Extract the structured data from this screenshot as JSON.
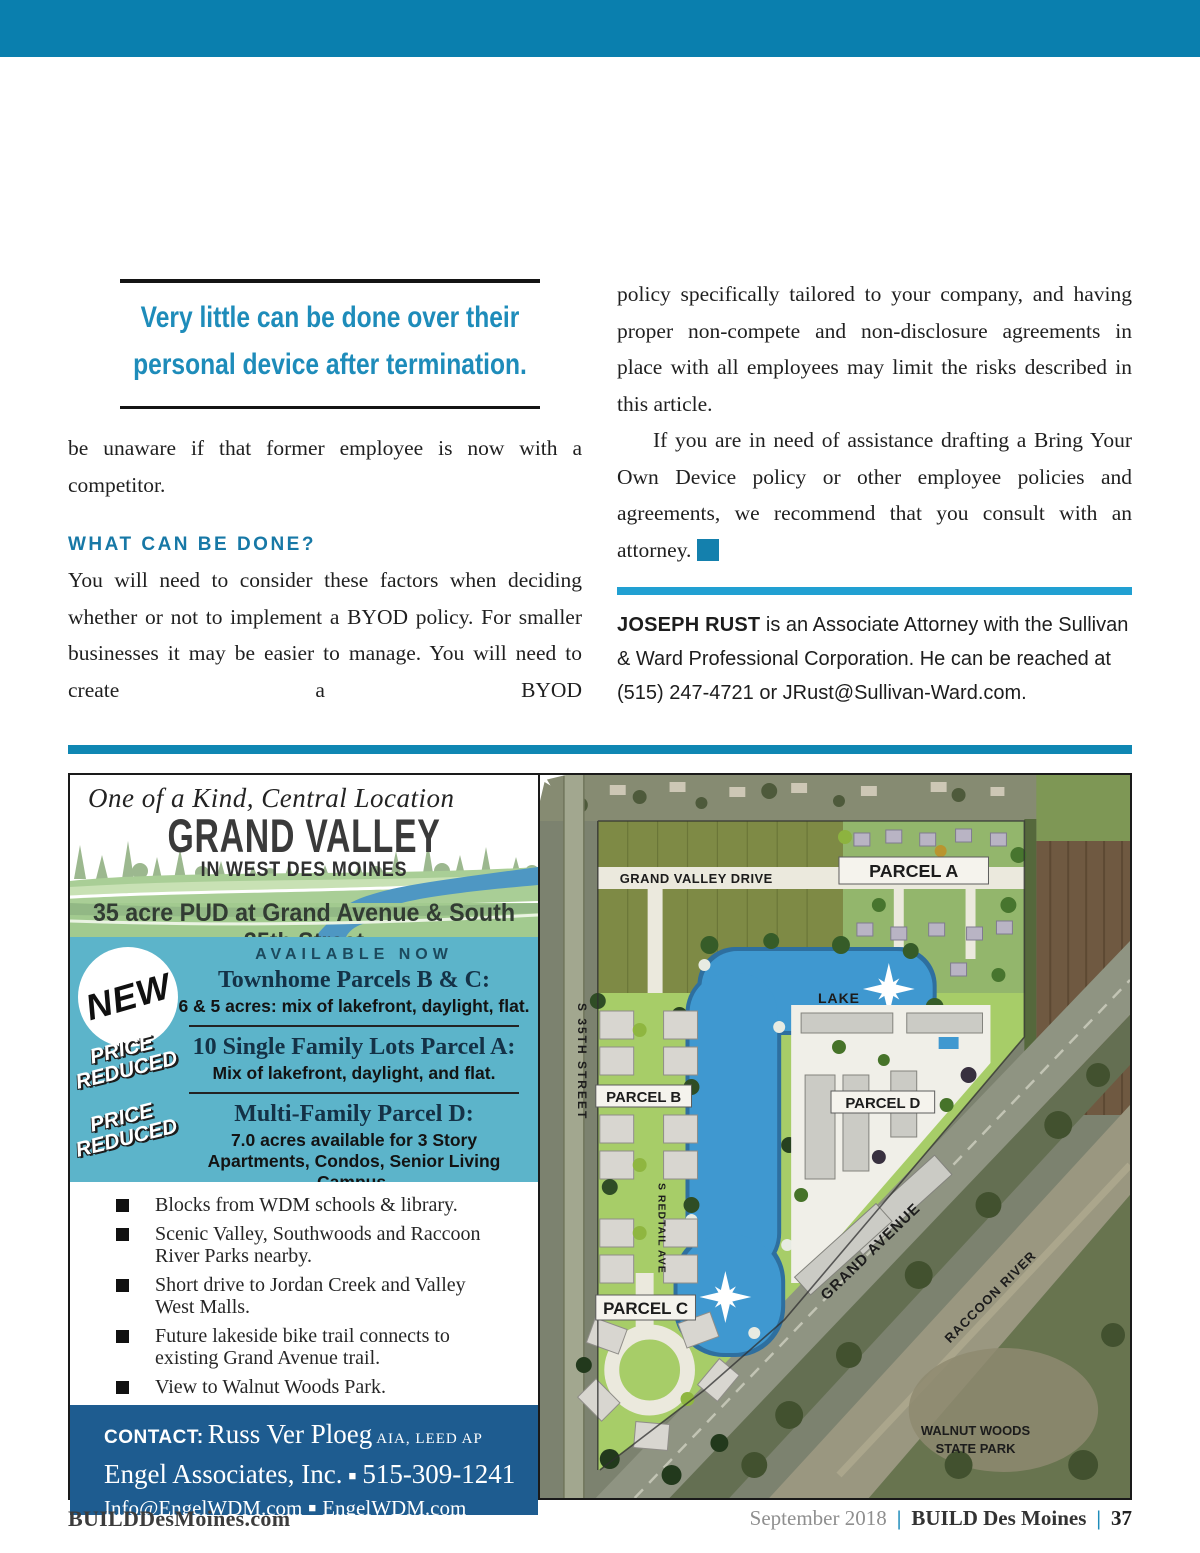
{
  "colors": {
    "top_bar": "#0a7fae",
    "quote_blue": "#1e8cba",
    "heading_blue": "#1778a6",
    "bio_rule_blue": "#21a0d2",
    "ad_divider_blue": "#0f87b3",
    "teal_panel": "#5cb4ca",
    "contact_blue": "#1e5c90"
  },
  "article": {
    "pull_quote": {
      "line1": "Very little can be done over their",
      "line2": "personal device after termination."
    },
    "left_column": {
      "para1": "be unaware if that former employee is now with a competitor.",
      "heading": "WHAT CAN BE DONE?",
      "para2": "You will need to consider these factors when deciding whether or not to implement a BYOD policy. For smaller businesses it may be easier to manage. You will need to create a BYOD"
    },
    "right_column": {
      "para1": "policy specifically tailored to your company, and having proper non-compete and non-disclosure agreements in place with all employees may limit the risks described in this article.",
      "para2": "If you are in need of assistance drafting a Bring Your Own Device policy or other employee policies and agreements, we recommend that you consult with an attorney.",
      "end_mark": "B",
      "bio_name": "JOSEPH RUST",
      "bio_rest": " is an Associate Attorney with the Sullivan & Ward Professional Corporation. He can be reached at (515) 247-4721 or JRust@Sullivan-Ward.com."
    }
  },
  "ad": {
    "tagline": "One of a Kind, Central Location",
    "title": "GRAND VALLEY",
    "subtitle": "IN WEST DES MOINES",
    "band": "35 acre PUD at Grand Avenue & South 35th Street",
    "available_now": "AVAILABLE NOW",
    "badges": {
      "new": "NEW",
      "price_reduced": "PRICE REDUCED"
    },
    "offers": [
      {
        "title": "Townhome Parcels B & C:",
        "desc": "6 & 5 acres: mix of lakefront, daylight, flat."
      },
      {
        "title": "10 Single Family Lots Parcel A:",
        "desc": "Mix of lakefront, daylight, and flat."
      },
      {
        "title": "Multi-Family Parcel D:",
        "desc": "7.0 acres available for 3 Story Apartments, Condos,  Senior Living Campus."
      }
    ],
    "bullets": [
      "Blocks from WDM schools & library.",
      "Scenic Valley, Southwoods and Raccoon River Parks nearby.",
      "Short drive to Jordan Creek and Valley West Malls.",
      "Future lakeside bike trail connects to existing Grand Avenue trail.",
      "View to Walnut Woods Park."
    ],
    "contact": {
      "label": "CONTACT:",
      "name": "Russ Ver Ploeg",
      "credentials": "AIA, LEED AP",
      "company": "Engel Associates, Inc.",
      "phone": "515-309-1241",
      "email": "Info@EngelWDM.com",
      "website": "EngelWDM.com",
      "bullet": "■"
    },
    "map": {
      "labels": {
        "drive": "GRAND VALLEY DRIVE",
        "parcel_a": "PARCEL A",
        "lake": "LAKE",
        "parcel_b": "PARCEL B",
        "parcel_d": "PARCEL D",
        "parcel_c": "PARCEL C",
        "s35": "S 35TH STREET",
        "redtail": "S REDTAIL AVE",
        "grand_ave": "GRAND AVENUE",
        "river": "RACCOON RIVER",
        "walnut1": "WALNUT WOODS",
        "walnut2": "STATE PARK"
      }
    }
  },
  "footer": {
    "site": "BUILDDesMoines.com",
    "date": "September 2018",
    "magazine": "BUILD Des Moines",
    "page": "37",
    "separator": "|"
  }
}
